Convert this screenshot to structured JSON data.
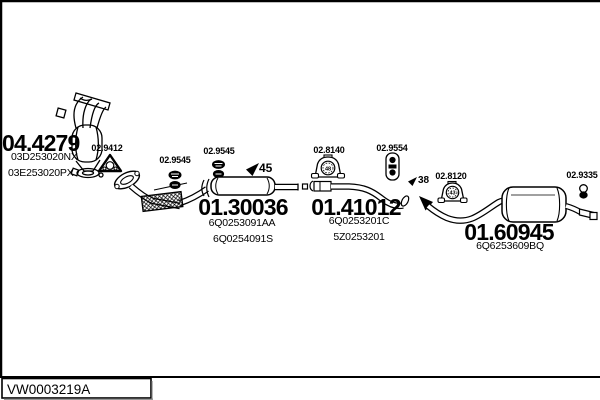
{
  "frame": {
    "footer_code": "VW0003219A"
  },
  "colors": {
    "ink": "#000000",
    "background": "#ffffff",
    "shadow": "#888888"
  },
  "parts": {
    "catalyst": {
      "ref": "04.4279",
      "oem1": "03D253020NX",
      "oem2": "03E253020PX"
    },
    "gasket": {
      "ref": "02.9412"
    },
    "clamp_front": {
      "ref": "02.9545"
    },
    "clamp_mid": {
      "ref": "02.9545"
    },
    "centre_silencer": {
      "ref": "01.30036",
      "oem1": "6Q0253091AA",
      "oem2": "6Q0254091S"
    },
    "diameter_45": {
      "value": "45"
    },
    "mount_48": {
      "ref": "02.8140",
      "size": "48"
    },
    "hanger_mid": {
      "ref": "02.9554"
    },
    "centre_pipe": {
      "ref": "01.41012",
      "oem1": "6Q0253201C",
      "oem2": "5Z0253201"
    },
    "diameter_38": {
      "value": "38"
    },
    "mount_43": {
      "ref": "02.8120",
      "size": "43"
    },
    "rear_silencer": {
      "ref": "01.60945",
      "oem1": "6Q6253609BQ"
    },
    "hanger_rear": {
      "ref": "02.9335"
    }
  }
}
